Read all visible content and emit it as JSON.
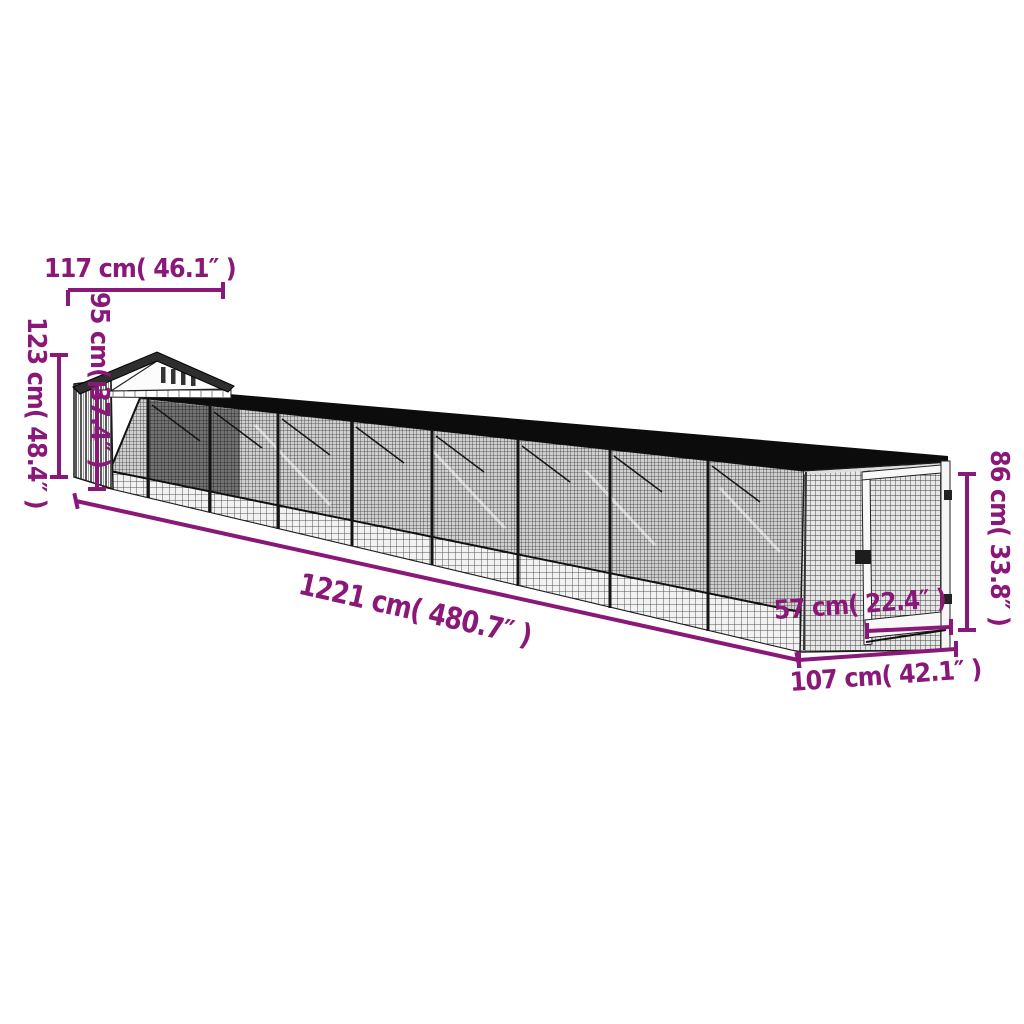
{
  "canvas": {
    "width": 1024,
    "height": 1024,
    "background": "#ffffff",
    "accent_color": "#8a1878",
    "roof_color": "#0c0c0c",
    "house_roof_color": "#2e2e2e"
  },
  "diagram": {
    "type": "product-dimension-diagram",
    "subject": "chicken-coop-with-long-mesh-run",
    "dimensions": [
      {
        "id": "house-width",
        "label": "117 cm( 46.1″ )",
        "cm": 117,
        "inches": 46.1
      },
      {
        "id": "wall-height",
        "label": "95 cm( 37.4″ )",
        "cm": 95,
        "inches": 37.4
      },
      {
        "id": "total-height",
        "label": "123 cm( 48.4″ )",
        "cm": 123,
        "inches": 48.4
      },
      {
        "id": "total-length",
        "label": "1221 cm( 480.7″ )",
        "cm": 1221,
        "inches": 480.7
      },
      {
        "id": "door-width",
        "label": "57 cm( 22.4″ )",
        "cm": 57,
        "inches": 22.4
      },
      {
        "id": "run-depth",
        "label": "107 cm( 42.1″ )",
        "cm": 107,
        "inches": 42.1
      },
      {
        "id": "run-height",
        "label": "86 cm( 33.8″ )",
        "cm": 86,
        "inches": 33.8
      }
    ]
  }
}
